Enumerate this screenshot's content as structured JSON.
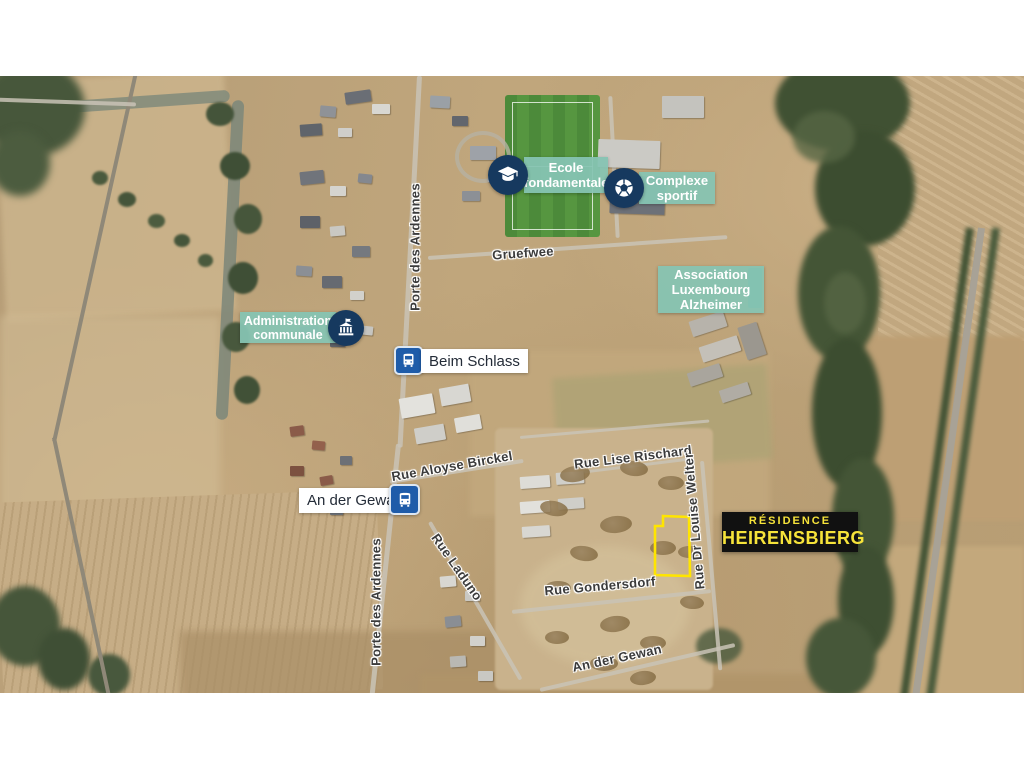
{
  "colors": {
    "badge_teal": "#86c3b2",
    "badge_navy": "#16395f",
    "bus_blue": "#1f5ca9",
    "residence_bg": "#111111",
    "residence_text": "#f6e33a",
    "street_label": "#3b3b3b",
    "site_outline": "#ffe500",
    "bus_label_text": "#242c38",
    "badge_text": "#ffffff"
  },
  "pois": {
    "ecole": {
      "line1": "Ecole",
      "line2": "fondamentale",
      "icon": "graduation-cap-icon"
    },
    "complexe": {
      "line1": "Complexe",
      "line2": "sportif",
      "icon": "soccer-ball-icon"
    },
    "association": {
      "line1": "Association",
      "line2": "Luxembourg",
      "line3": "Alzheimer"
    },
    "administration": {
      "line1": "Administration",
      "line2": "communale",
      "icon": "town-hall-icon"
    }
  },
  "bus_stops": {
    "beim_schlass": {
      "name": "Beim Schlass"
    },
    "an_der_gewan": {
      "name": "An der Gewan"
    }
  },
  "residence": {
    "line1": "RÉSIDENCE",
    "line2": "HEIRENSBIERG"
  },
  "streets": {
    "porte_des_ardennes_north": "Porte des Ardennes",
    "gruefwee": "Gruefwee",
    "rue_aloyse_birckel": "Rue Aloyse Birckel",
    "rue_lise_rischard": "Rue Lise Rischard",
    "rue_dr_louise_welter": "Rue Dr Louise Welter",
    "porte_des_ardennes_south": "Porte des Ardennes",
    "rue_laduno": "Rue Laduno",
    "rue_gondersdorf": "Rue Gondersdorf",
    "an_der_gewan_street": "An der Gewan"
  }
}
